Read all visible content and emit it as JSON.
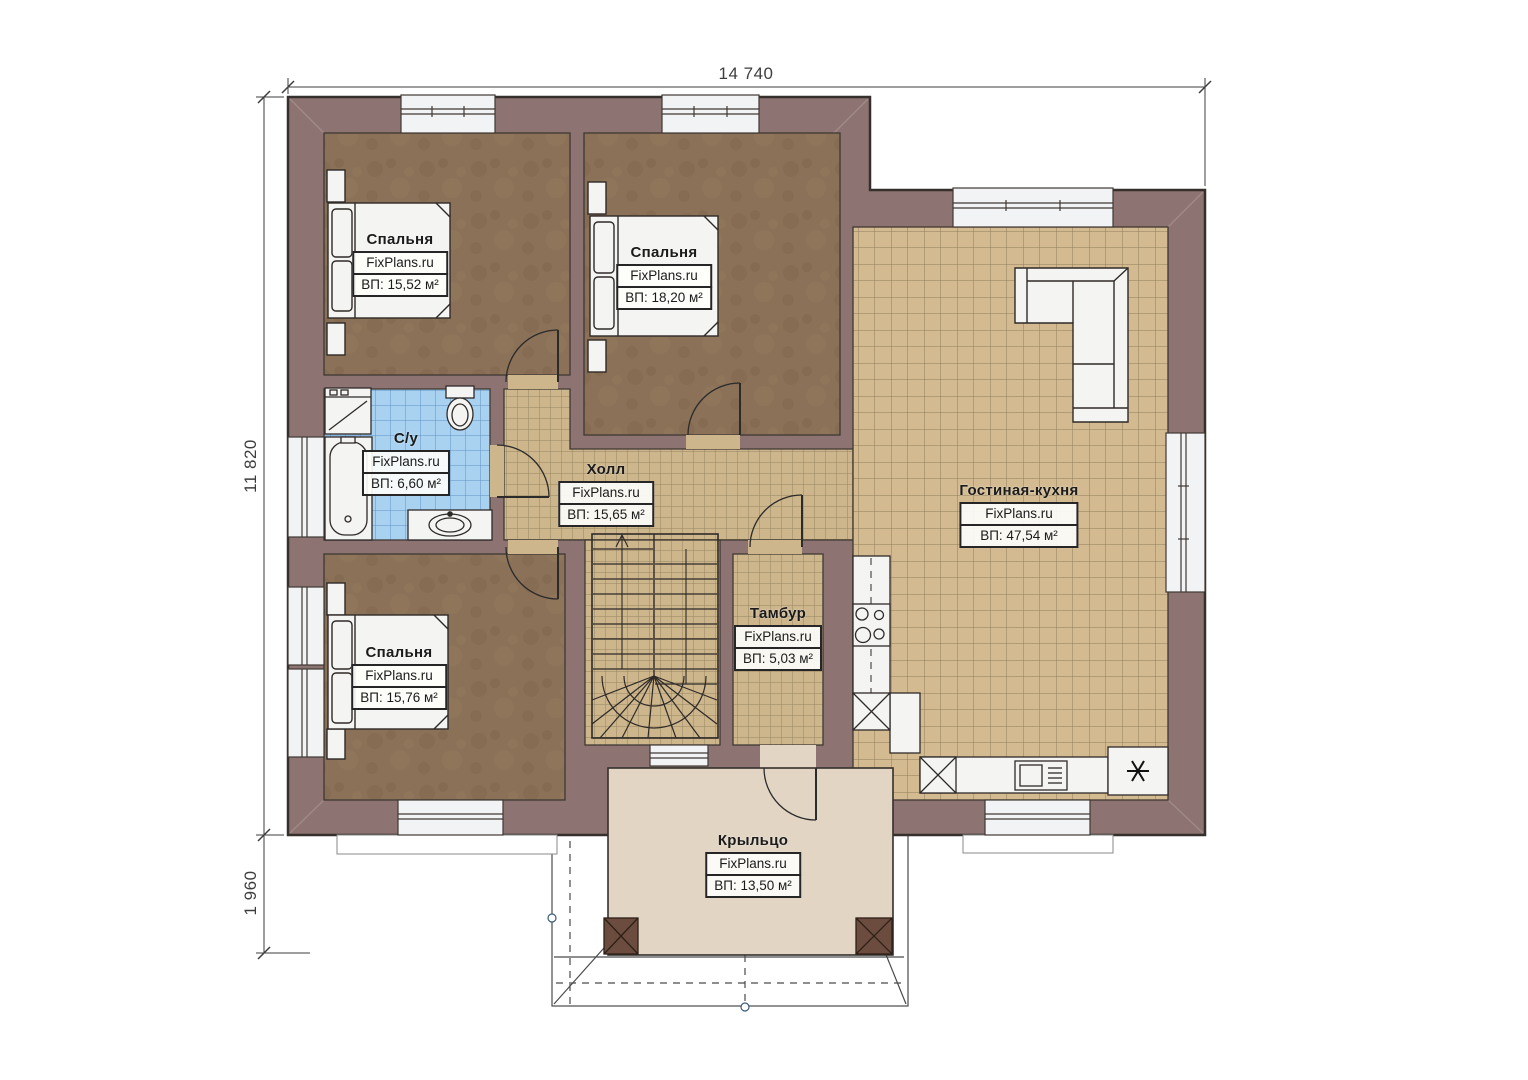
{
  "branding": {
    "site": "FixPlans.ru"
  },
  "dimensions": {
    "width_top": "14 740",
    "height_left": "11 820",
    "porch_depth": "1 960"
  },
  "rooms": [
    {
      "id": "bedroom-1",
      "name": "Спальня",
      "area": "ВП: 15,52 м²"
    },
    {
      "id": "bedroom-2",
      "name": "Спальня",
      "area": "ВП: 18,20 м²"
    },
    {
      "id": "bathroom",
      "name": "С/у",
      "area": "ВП: 6,60 м²"
    },
    {
      "id": "hall",
      "name": "Холл",
      "area": "ВП: 15,65 м²"
    },
    {
      "id": "living-kitchen",
      "name": "Гостиная-кухня",
      "area": "ВП: 47,54 м²"
    },
    {
      "id": "bedroom-3",
      "name": "Спальня",
      "area": "ВП: 15,76 м²"
    },
    {
      "id": "vestibule",
      "name": "Тамбур",
      "area": "ВП: 5,03 м²"
    },
    {
      "id": "porch",
      "name": "Крыльцо",
      "area": "ВП: 13,50 м²"
    }
  ],
  "colors": {
    "wall": "#8d7472",
    "bedroom_floor": "#8a7157",
    "hall_tile": "#cdb58c",
    "living_tile": "#d3ba90",
    "bath_tile": "#a9d2f0",
    "porch_floor": "#e2d5c3",
    "fixture_white": "#f4f4f2",
    "outline": "#35302c"
  }
}
